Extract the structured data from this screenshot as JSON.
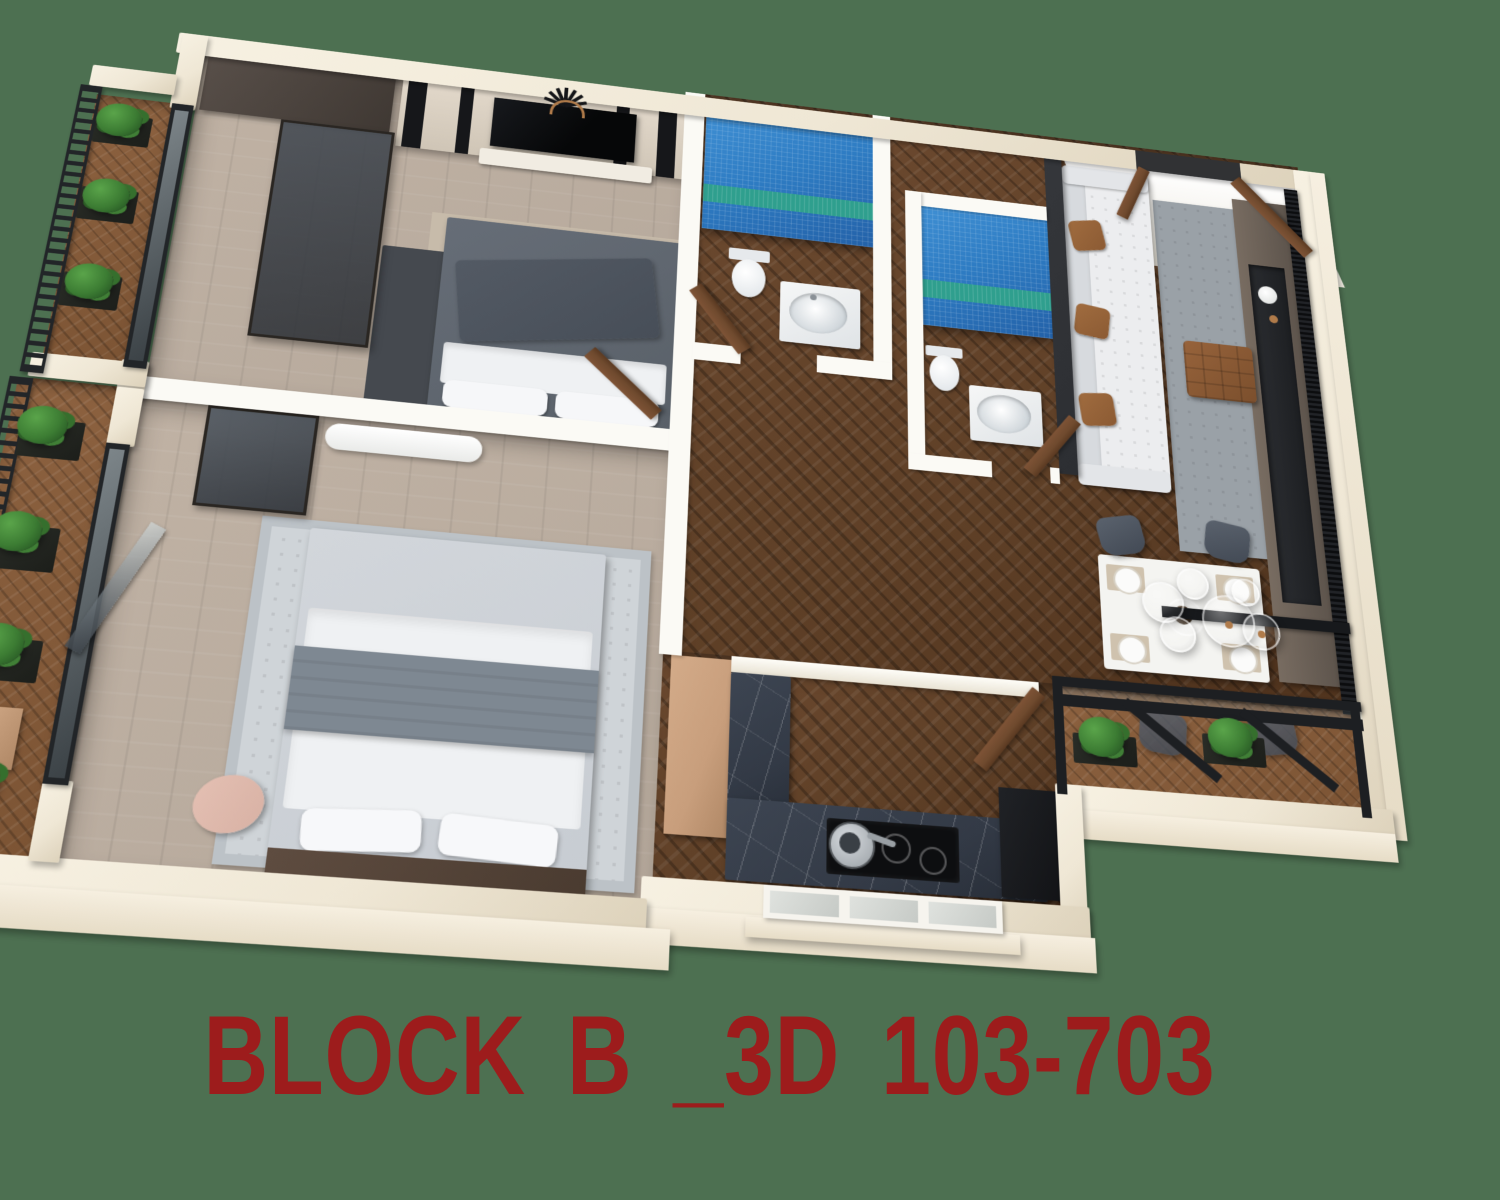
{
  "background_color": "#4d7051",
  "caption": {
    "text": "BLOCK B _3D 103-703",
    "color": "#9d1c1c"
  },
  "scene": {
    "type": "isometric-3d-floor-plan-render",
    "view": "two-bedroom apartment seen from above at an angle",
    "rooms": [
      {
        "name": "bedroom-1",
        "floor": "light-wood",
        "furniture": [
          "wardrobe",
          "wardrobe-glass-front",
          "tv-accent-wall",
          "television",
          "media-console",
          "sunburst-wall-decor",
          "double-bed-dark-gray",
          "beige-mat",
          "dark-gray-rug",
          "door-to-hallway"
        ]
      },
      {
        "name": "bedroom-2",
        "floor": "light-wood",
        "furniture": [
          "air-conditioner",
          "wall-mirror",
          "light-gray-rug",
          "double-bed-light",
          "gray-throw",
          "pillows",
          "wood-bench-headboard",
          "pink-accent-chair",
          "glass-doors-to-balcony"
        ]
      },
      {
        "name": "bathroom-1",
        "walls": "blue-mosaic-tile-with-teal-stripe",
        "floor": "dark-herringbone",
        "furniture": [
          "toilet",
          "vanity-with-oval-sink",
          "wood-door"
        ]
      },
      {
        "name": "bathroom-2",
        "walls": "blue-mosaic-tile-with-teal-stripe",
        "floor": "dark-herringbone",
        "furniture": [
          "toilet",
          "vanity-with-oval-sink",
          "wood-door"
        ]
      },
      {
        "name": "hallway",
        "floor": "dark-herringbone",
        "furniture": []
      },
      {
        "name": "kitchen",
        "floor": "dark-herringbone",
        "furniture": [
          "tall-tan-cabinet",
          "l-shaped-marble-counter",
          "white-pass-through-ledge",
          "induction-cooktop",
          "frying-pan",
          "black-refrigerator",
          "window",
          "wood-door"
        ]
      },
      {
        "name": "living-room",
        "floor": "dark-herringbone",
        "furniture": [
          "charcoal-partition-slab",
          "white-tufted-sofa",
          "brown-cushions",
          "gray-rug",
          "brown-leather-ottoman",
          "media-wall",
          "media-recess",
          "white-vase",
          "black-louver-panel",
          "black-shelf-bar",
          "entry-door"
        ]
      },
      {
        "name": "dining-area",
        "floor": "dark-herringbone",
        "furniture": [
          "white-dining-table",
          "placemats",
          "plates",
          "centerpiece",
          "dark-gray-chairs",
          "glass-globe-pendant-lights",
          "black-glass-partition"
        ]
      },
      {
        "name": "balcony-upper-left",
        "floor": "wood-herringbone",
        "furniture": [
          "black-slat-railing",
          "planters",
          "shrubs"
        ]
      },
      {
        "name": "balcony-lower-left",
        "floor": "wood-herringbone",
        "furniture": [
          "black-slat-railing",
          "planters",
          "shrubs",
          "tan-planter-box"
        ]
      },
      {
        "name": "balcony-right",
        "floor": "wood-herringbone",
        "furniture": [
          "black-frame-glass-partition",
          "diagonal-braces",
          "planters",
          "shrubs"
        ]
      }
    ],
    "palette": {
      "bg": "#4d7051",
      "wall": "#efe7d5",
      "wall-shade": "#ddd2bb",
      "wall-inner": "#fbfaf5",
      "metal": "#222528",
      "charcoal": "#2c2e32",
      "floor-light": "#b5a89b",
      "floor-dark": "#5f4027",
      "balcony-wood": "#7c5434",
      "tile-blue": "#2e7cc3",
      "tile-blue-deep": "#2361a8",
      "tile-stripe": "#2f9f8e",
      "rug-gray": "#9aa1a7",
      "rug-light": "#cfd4d8",
      "rug-dark": "#45494f",
      "mat-beige": "#c7bbaa",
      "sofa": "#ecedef",
      "pillow-brown": "#8b5a33",
      "wood-door": "#6f4a2e",
      "marble": "#333a46",
      "tan": "#c89e7c",
      "plant": "#3c7c33",
      "plant-dark": "#1f4a1e",
      "bed-dark": "#596068",
      "bed-light": "#c7ccd2",
      "throw": "#7e8892",
      "sheet": "#eff1f3",
      "pink": "#d8b1a4",
      "copper": "#b07b4a",
      "caption-red": "#9d1c1c"
    }
  }
}
